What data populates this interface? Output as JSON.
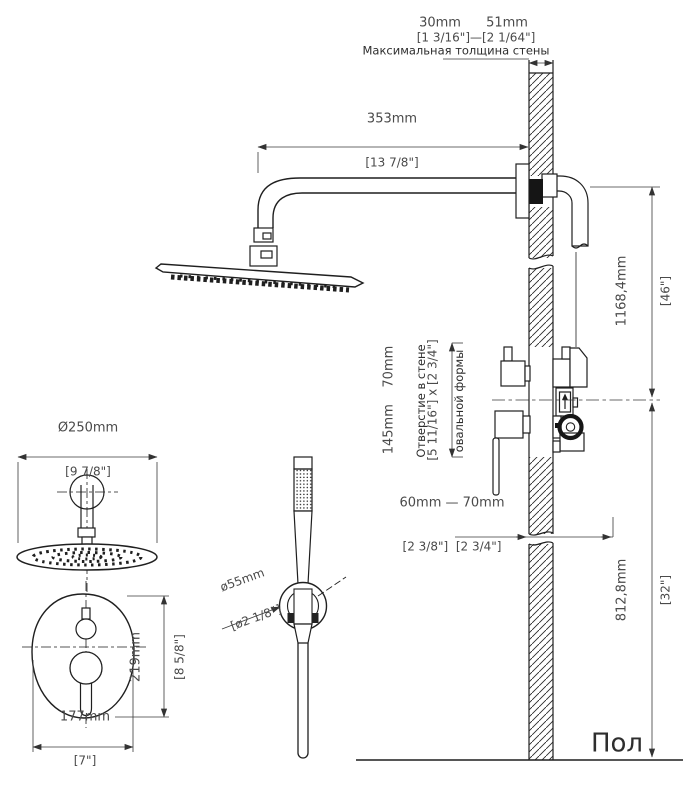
{
  "annotations": {
    "wall_thickness": {
      "min": "30mm",
      "max": "51mm",
      "inches": "[1 3/16\"]—[2 1/64\"]",
      "caption": "Максимальная толщина стены"
    },
    "arm_length": {
      "mm": "353mm",
      "inches": "[13 7/8\"]"
    },
    "arm_to_valve_height": {
      "mm": "1168,4mm",
      "inches": "[46\"]"
    },
    "wall_hole": {
      "size_mm": "145mm    70mm",
      "size_inches": "[5 11/16\"] x [2 3/4\"]",
      "caption_line1": "Отверстие в стене",
      "caption_line2": "овальной формы"
    },
    "valve_depth": {
      "mm": "60mm — 70mm",
      "inches": "[2 3/8\"]  [2 3/4\"]"
    },
    "valve_to_floor_height": {
      "mm": "812,8mm",
      "inches": "[32\"]"
    },
    "floor_label": "Пол",
    "head_diameter": {
      "mm": "Ø250mm",
      "inches": "[9 7/8\"]"
    },
    "trim_plate_height": {
      "mm": "219mm",
      "inches": "[8 5/8\"]"
    },
    "trim_plate_width": {
      "mm": "177mm",
      "inches": "[7\"]"
    },
    "holder_diameter": {
      "mm": "ø55mm",
      "inches": "[ø2 1/8\"]"
    }
  },
  "colors": {
    "line": "#1f1f1f",
    "dim_text": "#4a4a4a",
    "caption_text": "#2e2e2e"
  }
}
